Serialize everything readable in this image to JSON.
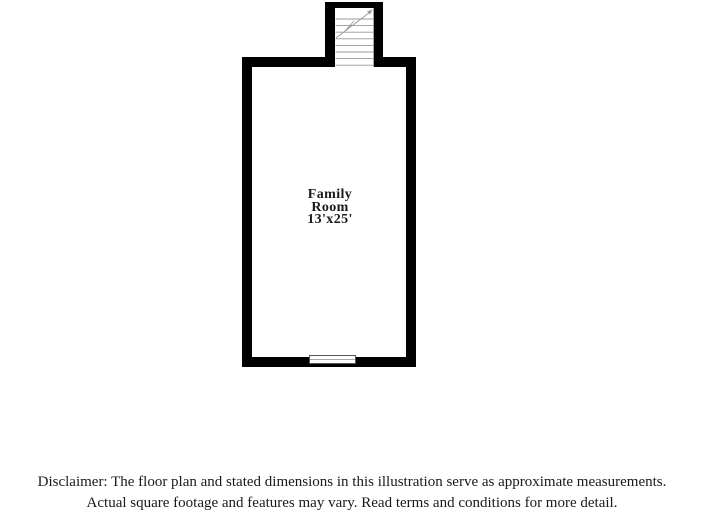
{
  "page": {
    "width_px": 704,
    "height_px": 517
  },
  "floor_plan": {
    "room": {
      "name_line1": "Family",
      "name_line2": "Room",
      "dimensions": "13'x25'"
    },
    "icons": {
      "staircase": "staircase-treads-with-up-arrow",
      "window": "window-double-line-symbol"
    }
  },
  "disclaimer": {
    "line1": "Disclaimer: The floor plan and stated dimensions in this illustration serve as approximate measurements.",
    "line2": "Actual square footage and features may vary. Read terms and conditions for more detail."
  },
  "colors": {
    "wall": "#000000",
    "background": "#ffffff",
    "stair_line": "#999999",
    "window_border": "#555555",
    "window_line": "#aaaaaa",
    "text": "#1a1a1a"
  }
}
